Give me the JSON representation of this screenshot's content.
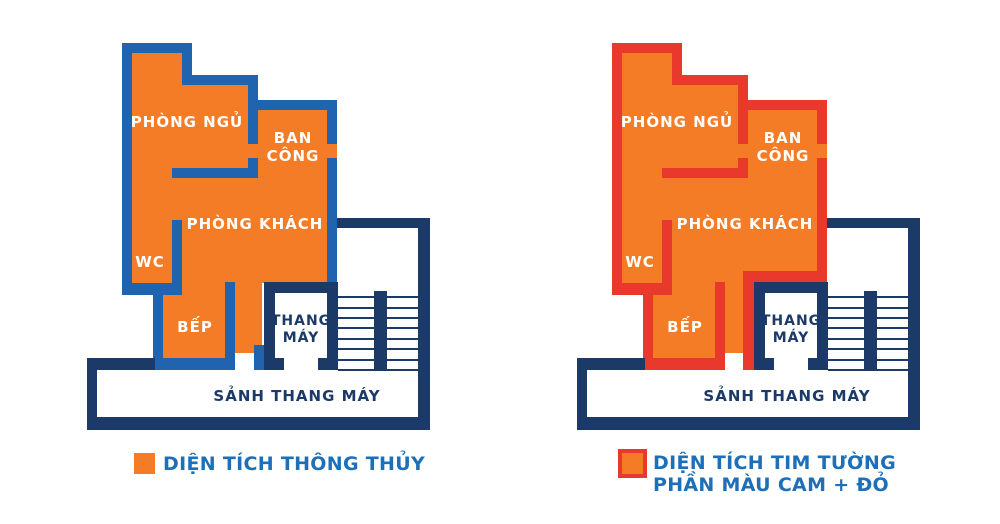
{
  "colors": {
    "orange_fill": "#F47C26",
    "blue_wall": "#2063AE",
    "red_wall": "#E8392C",
    "navy": "#1B3A68",
    "legend_text": "#1D6FB8",
    "label_white": "#FFFFFF",
    "background": "#FFFFFF"
  },
  "rooms": {
    "bedroom": "PHÒNG NGỦ",
    "balcony_line1": "BAN",
    "balcony_line2": "CÔNG",
    "living_room": "PHÒNG KHÁCH",
    "wc": "WC",
    "kitchen": "BẾP",
    "elevator_line1": "THANG",
    "elevator_line2": "MÁY",
    "lobby": "SẢNH THANG MÁY"
  },
  "left_panel": {
    "legend": "DIỆN TÍCH THÔNG THỦY"
  },
  "right_panel": {
    "legend_line1": "DIỆN TÍCH TIM TƯỜNG",
    "legend_line2": "PHẦN MÀU CAM + ĐỎ"
  }
}
